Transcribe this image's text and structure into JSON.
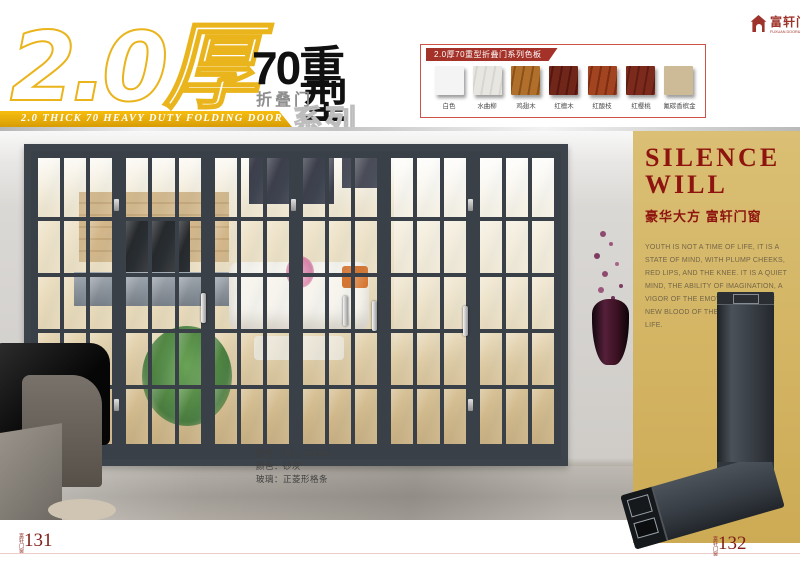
{
  "header": {
    "big_number": "2.0厚",
    "series_cn_1": "70重",
    "series_cn_2": "型",
    "series_cn_sub": "折叠门",
    "series_cn_tail": "系列",
    "banner": "2.0 THICK 70 HEAVY DUTY FOLDING DOOR SERIES",
    "accent_gold": "#eab41c"
  },
  "logo": {
    "name_cn": "富轩门窗",
    "name_en": "FUXUAN DOOR&WINDOW",
    "color": "#9e332b"
  },
  "color_board": {
    "title": "2.0厚70重型折叠门系列色板",
    "border_color": "#cf5248",
    "title_bg": "#a43229",
    "swatches": [
      {
        "label": "白色",
        "color": "#f4f4f4"
      },
      {
        "label": "水曲柳",
        "color": "#e8e6e1",
        "grain": "#d9d6cf"
      },
      {
        "label": "鸡翅木",
        "color": "#b06f2a",
        "grain": "#8a5118"
      },
      {
        "label": "红檀木",
        "color": "#71261a",
        "grain": "#541710"
      },
      {
        "label": "红酸枝",
        "color": "#a24420",
        "grain": "#7c2d12"
      },
      {
        "label": "红樱桃",
        "color": "#7c2a1c",
        "grain": "#5e1c12"
      },
      {
        "label": "氟碳香槟金",
        "color": "#cdbb97"
      }
    ]
  },
  "photo": {
    "door": {
      "panels": 6,
      "cols": 3,
      "rows": 5,
      "frame_color": "#3d434a"
    },
    "info_lines": [
      "型号：FX - 15103",
      "颜色：砂灰",
      "玻璃：正菱形格条"
    ]
  },
  "side_panel": {
    "title_line1": "SILENCE",
    "title_line2": "WILL",
    "subtitle": "豪华大方  富轩门窗",
    "body": "YOUTH IS NOT A TIME OF LIFE, IT IS A STATE OF MIND, WITH PLUMP CHEEKS, RED LIPS, AND THE KNEE. IT IS A QUIET MIND, THE ABILITY OF IMAGINATION, A VIGOR OF THE EMOTIONS, IT IS THE NEW BLOOD OF THE FOUNTAIN OF LIFE.",
    "accent_color": "#8e150f",
    "bg_color": "#d0b261"
  },
  "footer": {
    "left_page": "131",
    "right_page": "132",
    "page_marker": "富轩门窗"
  }
}
